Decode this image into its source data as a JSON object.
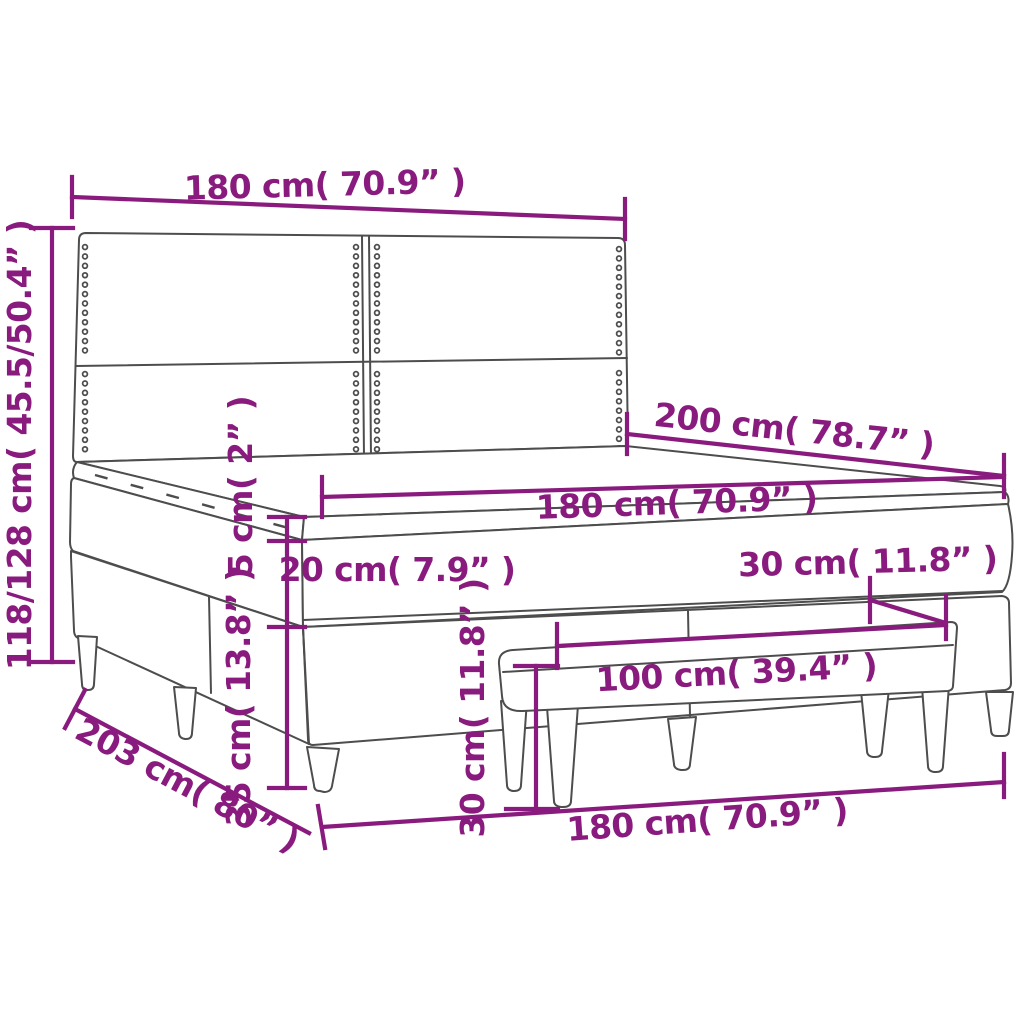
{
  "diagram": {
    "kind": "product-dimension-diagram",
    "subject": "box spring bed with headboard, mattress topper and bench",
    "colors": {
      "dimension_annotation": "#8a1b7e",
      "drawing_outline": "#4d4d4d",
      "background": "#ffffff"
    },
    "dimensions": {
      "headboard_width": {
        "label": "180 cm( 70.9” )"
      },
      "headboard_height": {
        "label": "118/128 cm( 45.5/50.4” )"
      },
      "bed_length": {
        "label": "200 cm( 78.7” )"
      },
      "mattress_width": {
        "label": "180 cm( 70.9” )"
      },
      "topper_height": {
        "label": "5 cm( 2” )"
      },
      "mattress_height": {
        "label": "20 cm( 7.9” )"
      },
      "box_spring_height": {
        "label": "35 cm( 13.8” )"
      },
      "bench_height": {
        "label": "30 cm( 11.8” )"
      },
      "bench_length": {
        "label": "100 cm( 39.4” )"
      },
      "bench_depth": {
        "label": "30 cm( 11.8” )"
      },
      "frame_length": {
        "label": "203 cm( 80” )"
      },
      "frame_width": {
        "label": "180 cm( 70.9” )"
      }
    }
  }
}
